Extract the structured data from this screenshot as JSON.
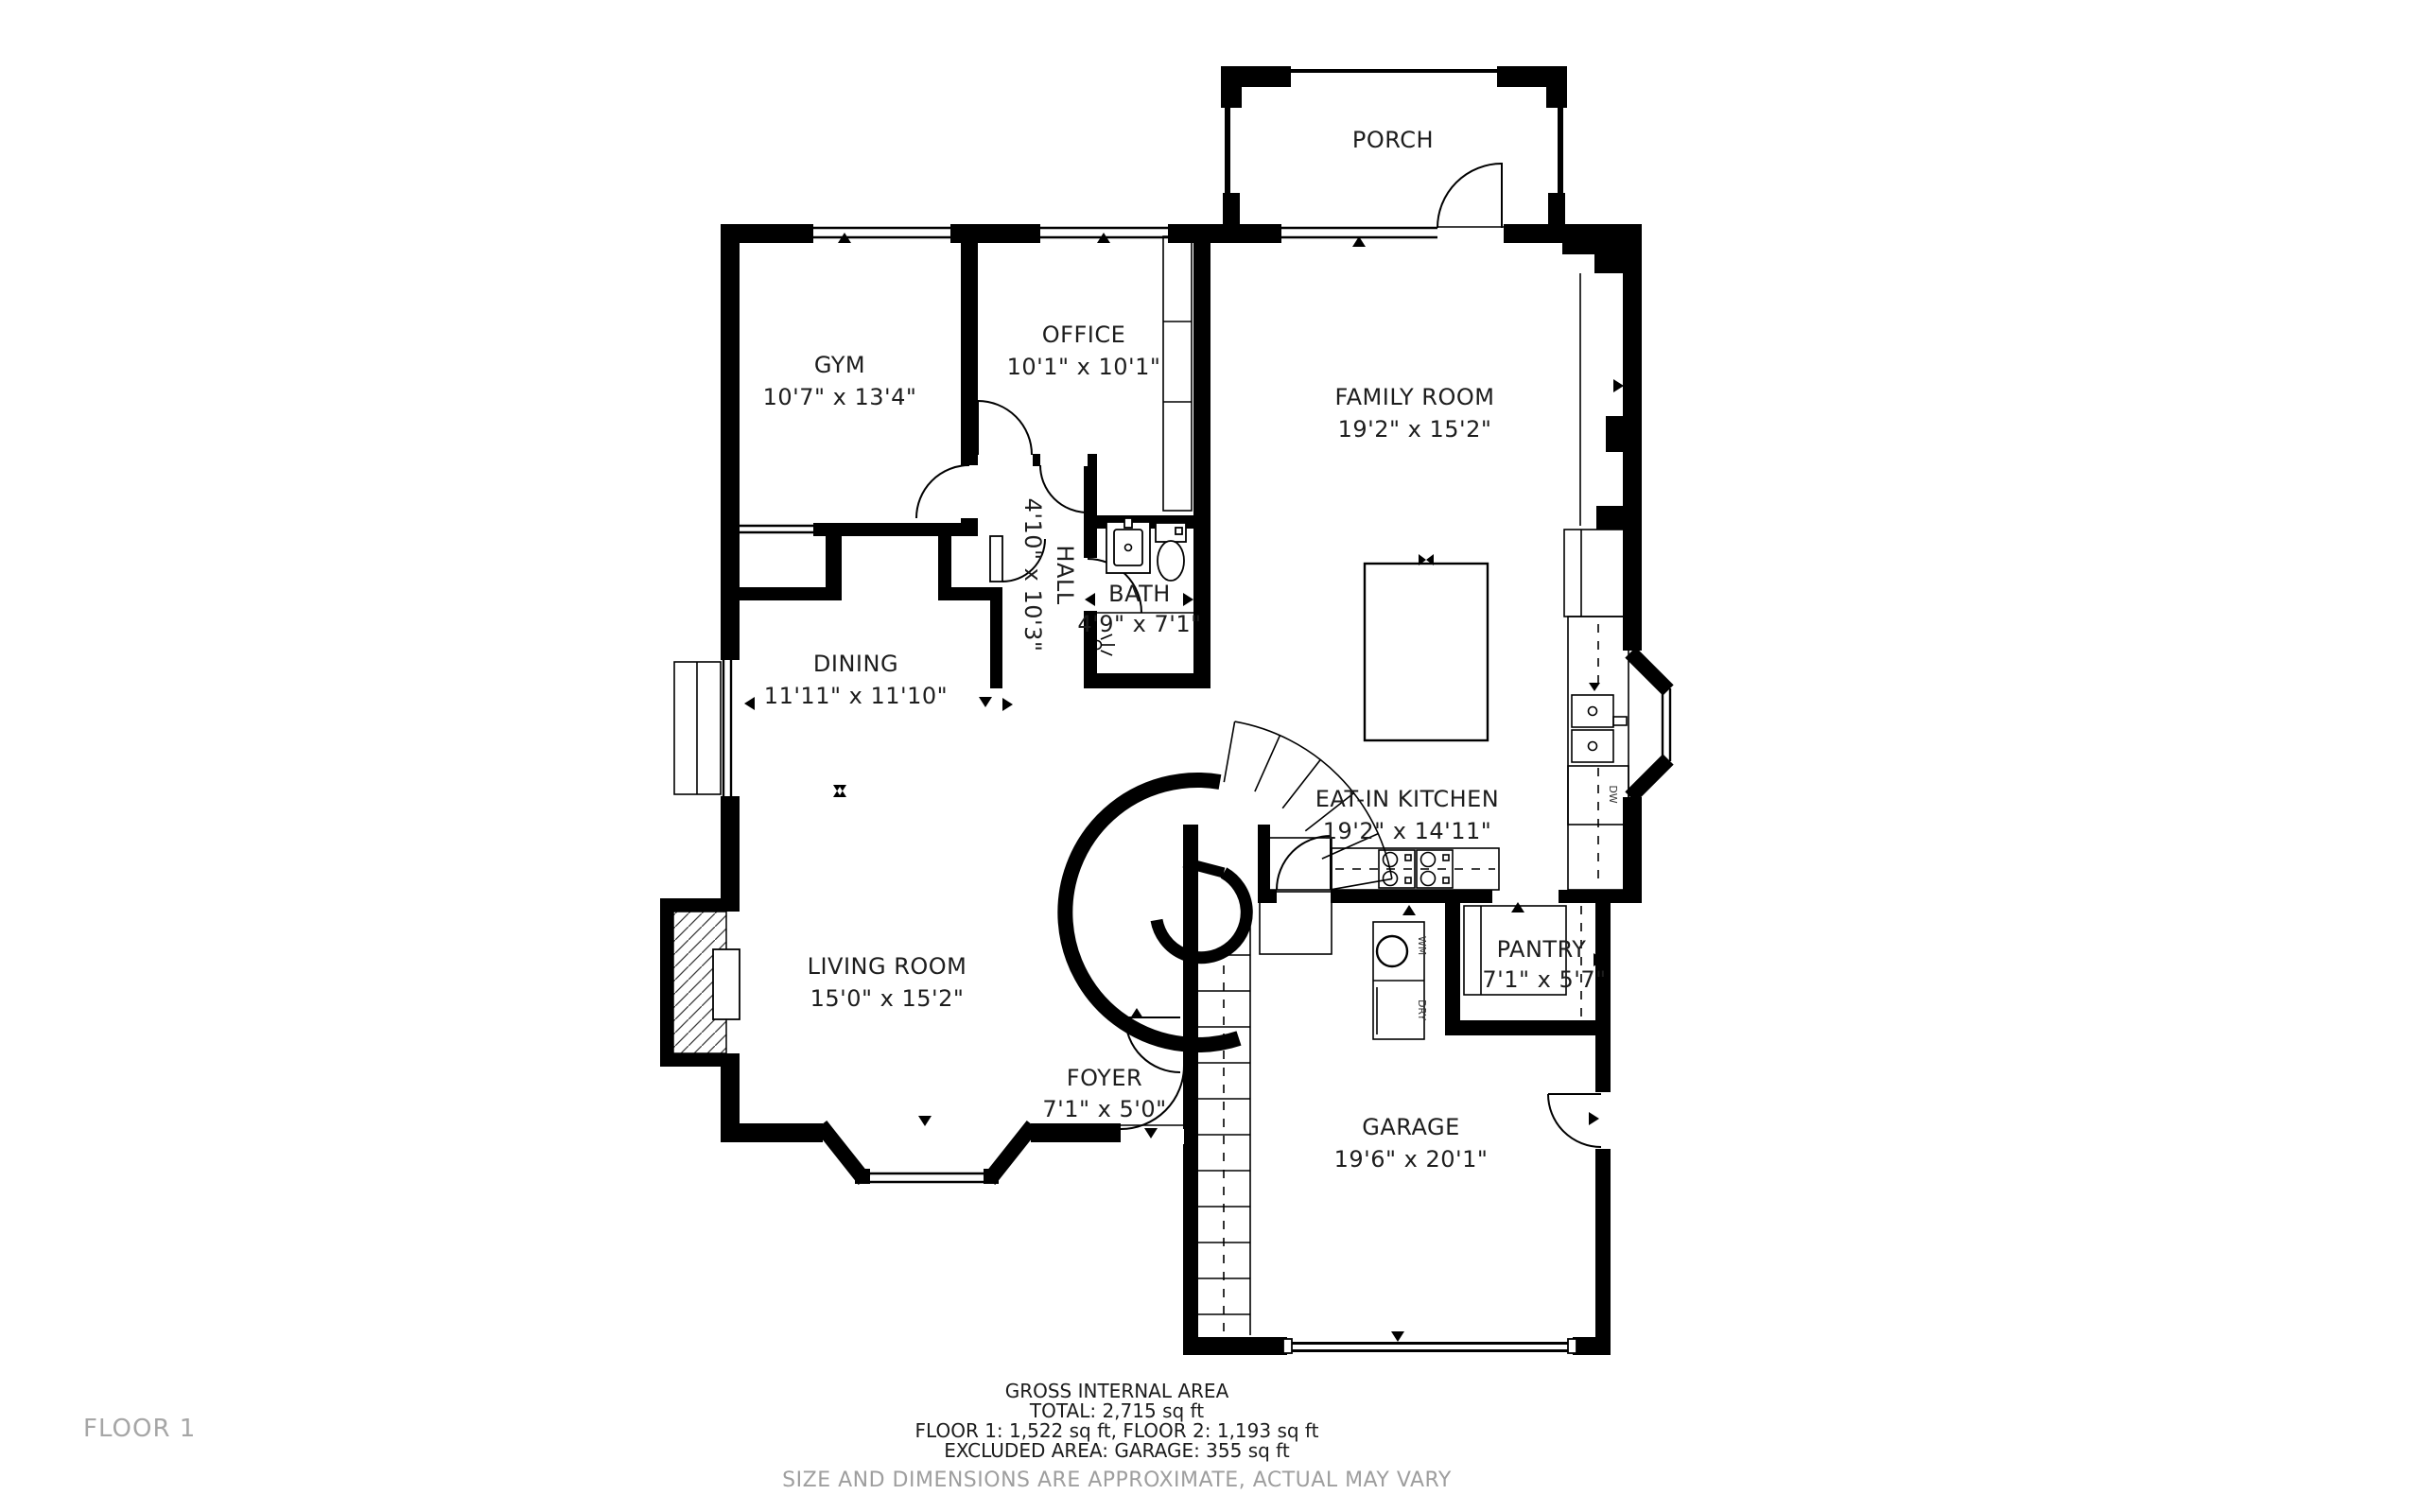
{
  "floor_label": "FLOOR 1",
  "rooms": [
    {
      "id": "porch",
      "name": "PORCH",
      "dims": ""
    },
    {
      "id": "gym",
      "name": "GYM",
      "dims": "10'7\" x 13'4\""
    },
    {
      "id": "office",
      "name": "OFFICE",
      "dims": "10'1\" x 10'1\""
    },
    {
      "id": "family",
      "name": "FAMILY ROOM",
      "dims": "19'2\" x 15'2\""
    },
    {
      "id": "hall",
      "name": "HALL",
      "dims": "4'10\" x 10'3\""
    },
    {
      "id": "bath",
      "name": "BATH",
      "dims": "4'9\" x 7'1\""
    },
    {
      "id": "dining",
      "name": "DINING",
      "dims": "11'11\" x 11'10\""
    },
    {
      "id": "kitchen",
      "name": "EAT-IN KITCHEN",
      "dims": "19'2\" x 14'11\""
    },
    {
      "id": "living",
      "name": "LIVING ROOM",
      "dims": "15'0\" x 15'2\""
    },
    {
      "id": "foyer",
      "name": "FOYER",
      "dims": "7'1\" x 5'0\""
    },
    {
      "id": "pantry",
      "name": "PANTRY",
      "dims": "7'1\" x 5'7\""
    },
    {
      "id": "garage",
      "name": "GARAGE",
      "dims": "19'6\" x 20'1\""
    }
  ],
  "appliances": {
    "washer": "WM",
    "dryer": "DRY",
    "dishwasher": "DW"
  },
  "footer": {
    "line1": "GROSS INTERNAL AREA",
    "line2": "TOTAL: 2,715 sq ft",
    "line3": "FLOOR 1: 1,522 sq ft, FLOOR 2: 1,193 sq ft",
    "line4": "EXCLUDED AREA: GARAGE: 355 sq ft",
    "disclaimer": "SIZE AND DIMENSIONS ARE APPROXIMATE, ACTUAL MAY VARY"
  },
  "colors": {
    "wall": "#000000",
    "text": "#1d1d1d",
    "muted": "#9e9e9e"
  }
}
